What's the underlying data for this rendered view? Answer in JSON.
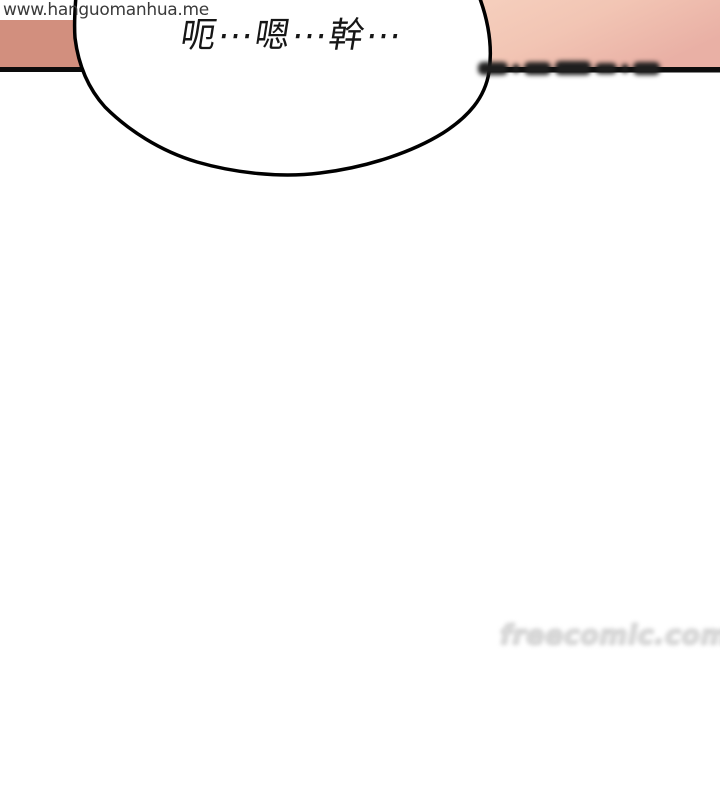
{
  "page": {
    "width": 720,
    "height": 800,
    "background": "#ffffff"
  },
  "site_watermark": {
    "text": "www.hanguomanhua.me",
    "color": "#3a3a3a"
  },
  "speech_bubble": {
    "text": "呃⋯嗯⋯幹⋯",
    "fill": "#ffffff",
    "outline_color": "#000000",
    "text_color": "#161616"
  },
  "panel": {
    "skin_left_color": "#d28f7e",
    "skin_right_gradient": {
      "start": "#f6d1bf",
      "mid": "#f2c5b4",
      "end": "#e9b0a5"
    },
    "border_line_color": "#0c0c0c"
  },
  "watermarks": {
    "top_blurred": {
      "legible": false,
      "color": "#1e1e1e"
    },
    "bottom_blurred": {
      "legible": false,
      "approx_text": "freecomic.com",
      "color": "#dedede"
    }
  }
}
